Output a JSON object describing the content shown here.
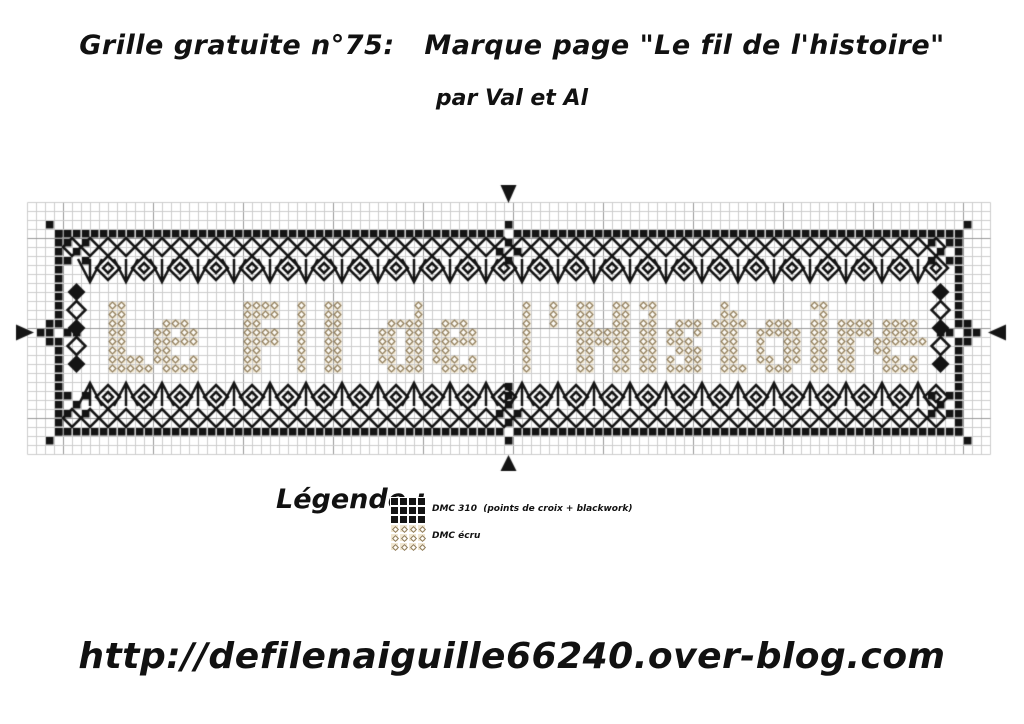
{
  "header": {
    "title": "Grille gratuite n°75:   Marque page \"Le fil de l'histoire\"",
    "subtitle": "par Val et Al"
  },
  "footer": {
    "url": "http://defilenaiguille66240.over-blog.com"
  },
  "legend": {
    "heading": "Légende :",
    "items": [
      {
        "thread": "DMC 310",
        "label": "DMC 310  (points de croix + blackwork)",
        "swatch": "solid-black-squares"
      },
      {
        "thread": "DMC écru",
        "label": "DMC écru",
        "swatch": "ecru-diamond-outlines"
      }
    ]
  },
  "pattern": {
    "stitched_text": "Le Fil de l'Histoire",
    "techniques": [
      "points de croix",
      "blackwork"
    ],
    "grid": {
      "cols": 107,
      "rows": 28,
      "cell_px": 9,
      "origin_x": 27,
      "origin_y": 27,
      "major_every": 10,
      "major_col_offset": 4,
      "major_row_offset": 4
    },
    "bookmark_border": {
      "left": 3,
      "right": 103,
      "top": 3,
      "bottom": 25
    },
    "border_gaps": [
      [
        53,
        3
      ],
      [
        53,
        25
      ],
      [
        3,
        14
      ],
      [
        103,
        14
      ]
    ],
    "corner_dots": [
      [
        2,
        2
      ],
      [
        104,
        2
      ],
      [
        2,
        26
      ],
      [
        104,
        26
      ]
    ],
    "center_clusters": {
      "top": [
        [
          53,
          2
        ],
        [
          53,
          4
        ],
        [
          52,
          5
        ],
        [
          54,
          5
        ],
        [
          53,
          6
        ]
      ],
      "bottom": [
        [
          53,
          26
        ],
        [
          53,
          24
        ],
        [
          52,
          23
        ],
        [
          54,
          23
        ],
        [
          53,
          22
        ],
        [
          53,
          21
        ],
        [
          53,
          20
        ]
      ],
      "left": [
        [
          1,
          14
        ],
        [
          2,
          13
        ],
        [
          2,
          14
        ],
        [
          2,
          15
        ],
        [
          4,
          14
        ],
        [
          5,
          14
        ]
      ],
      "right": [
        [
          105,
          14
        ],
        [
          104,
          13
        ],
        [
          104,
          14
        ],
        [
          104,
          15
        ],
        [
          102,
          14
        ],
        [
          101,
          14
        ]
      ]
    },
    "corner_checker_origins": [
      [
        4,
        4
      ],
      [
        100,
        4
      ],
      [
        4,
        21
      ],
      [
        100,
        21
      ]
    ],
    "corner_checker_offsets": [
      [
        0,
        0
      ],
      [
        2,
        0
      ],
      [
        1,
        1
      ],
      [
        0,
        2
      ],
      [
        2,
        2
      ]
    ],
    "text_area": {
      "col": 7,
      "row": 10,
      "cols": 94,
      "rows": 11
    },
    "colors": {
      "stitch": "#141414",
      "grid_minor": "#cccccc",
      "grid_major": "#999999",
      "ecru_outline": "#8d7a58",
      "ecru_cell_bg": "#f0e6d0",
      "ecru_fill": "#fffdf8"
    },
    "center_markers": [
      "top",
      "bottom",
      "left",
      "right"
    ]
  }
}
